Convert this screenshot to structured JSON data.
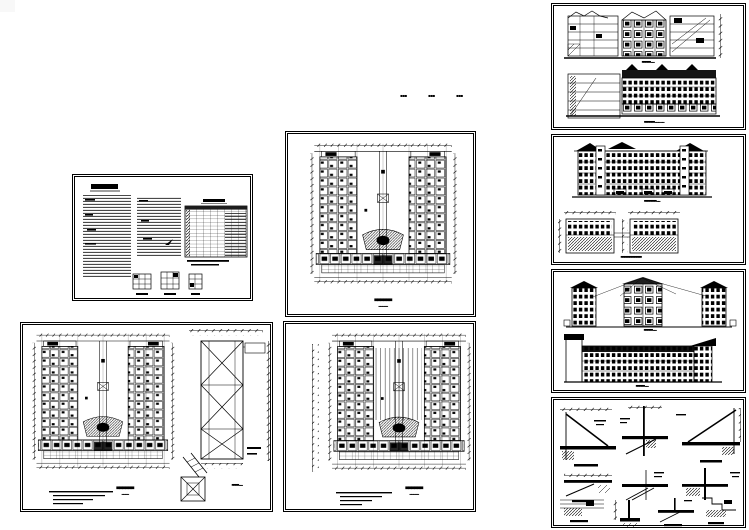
{
  "canvas": {
    "width": 749,
    "height": 530,
    "background": "#ffffff",
    "ink": "#000000",
    "corner_square_color": "#f8f8f8"
  },
  "annotation_marks": {
    "m1": "▪▪▪",
    "m2": "▪▪▪",
    "m3": "▪▪▪"
  },
  "sheets": {
    "notes": {
      "name": "design-notes-sheet",
      "kind": "general-notes + schedule-table + window-details"
    },
    "plan1": {
      "name": "floor-plan-sheet-1",
      "kind": "u-shaped floor plan",
      "caption": "▄▄▄▄▄▄",
      "scale": "▂▂▂ ▂▂"
    },
    "plan2": {
      "name": "floor-plan-sheet-2",
      "kind": "u-shaped floor plan + stair tower detail",
      "caption": "▄▄▄▄▄▄",
      "scale": "▂▂▂▂",
      "detail_caption": "▄▄▄▄ ▂▂"
    },
    "plan3": {
      "name": "floor-plan-sheet-3",
      "kind": "u-shaped floor plan",
      "caption": "▄▄▄▄▄▄",
      "scale": "▂▂▂ ▂▂"
    },
    "elev1": {
      "name": "elevation-sheet-1",
      "kind": "section-elevation above long elevation",
      "caption_top": "▄▄▄▄▄ ▂▂",
      "caption_bottom": "▄▄▄▄▄▄ ▂▂▂  ▂▂"
    },
    "elev2": {
      "name": "elevation-sheet-2",
      "kind": "elevation + two partial plans",
      "caption_top": "▄▄▄▄▄▄▄ ▂▂",
      "caption_bottom": "▄▄▄▄▄▄▄▄▄▄▄▄"
    },
    "elev3": {
      "name": "elevation-sheet-3",
      "kind": "two elevations",
      "caption_top": "▄▄▄▄▄ ▂▂",
      "caption_bottom": "▄▄▄▄▄ ▂▂"
    },
    "details": {
      "name": "construction-details-sheet",
      "kind": "eave / cornice / footing detail sections"
    }
  }
}
